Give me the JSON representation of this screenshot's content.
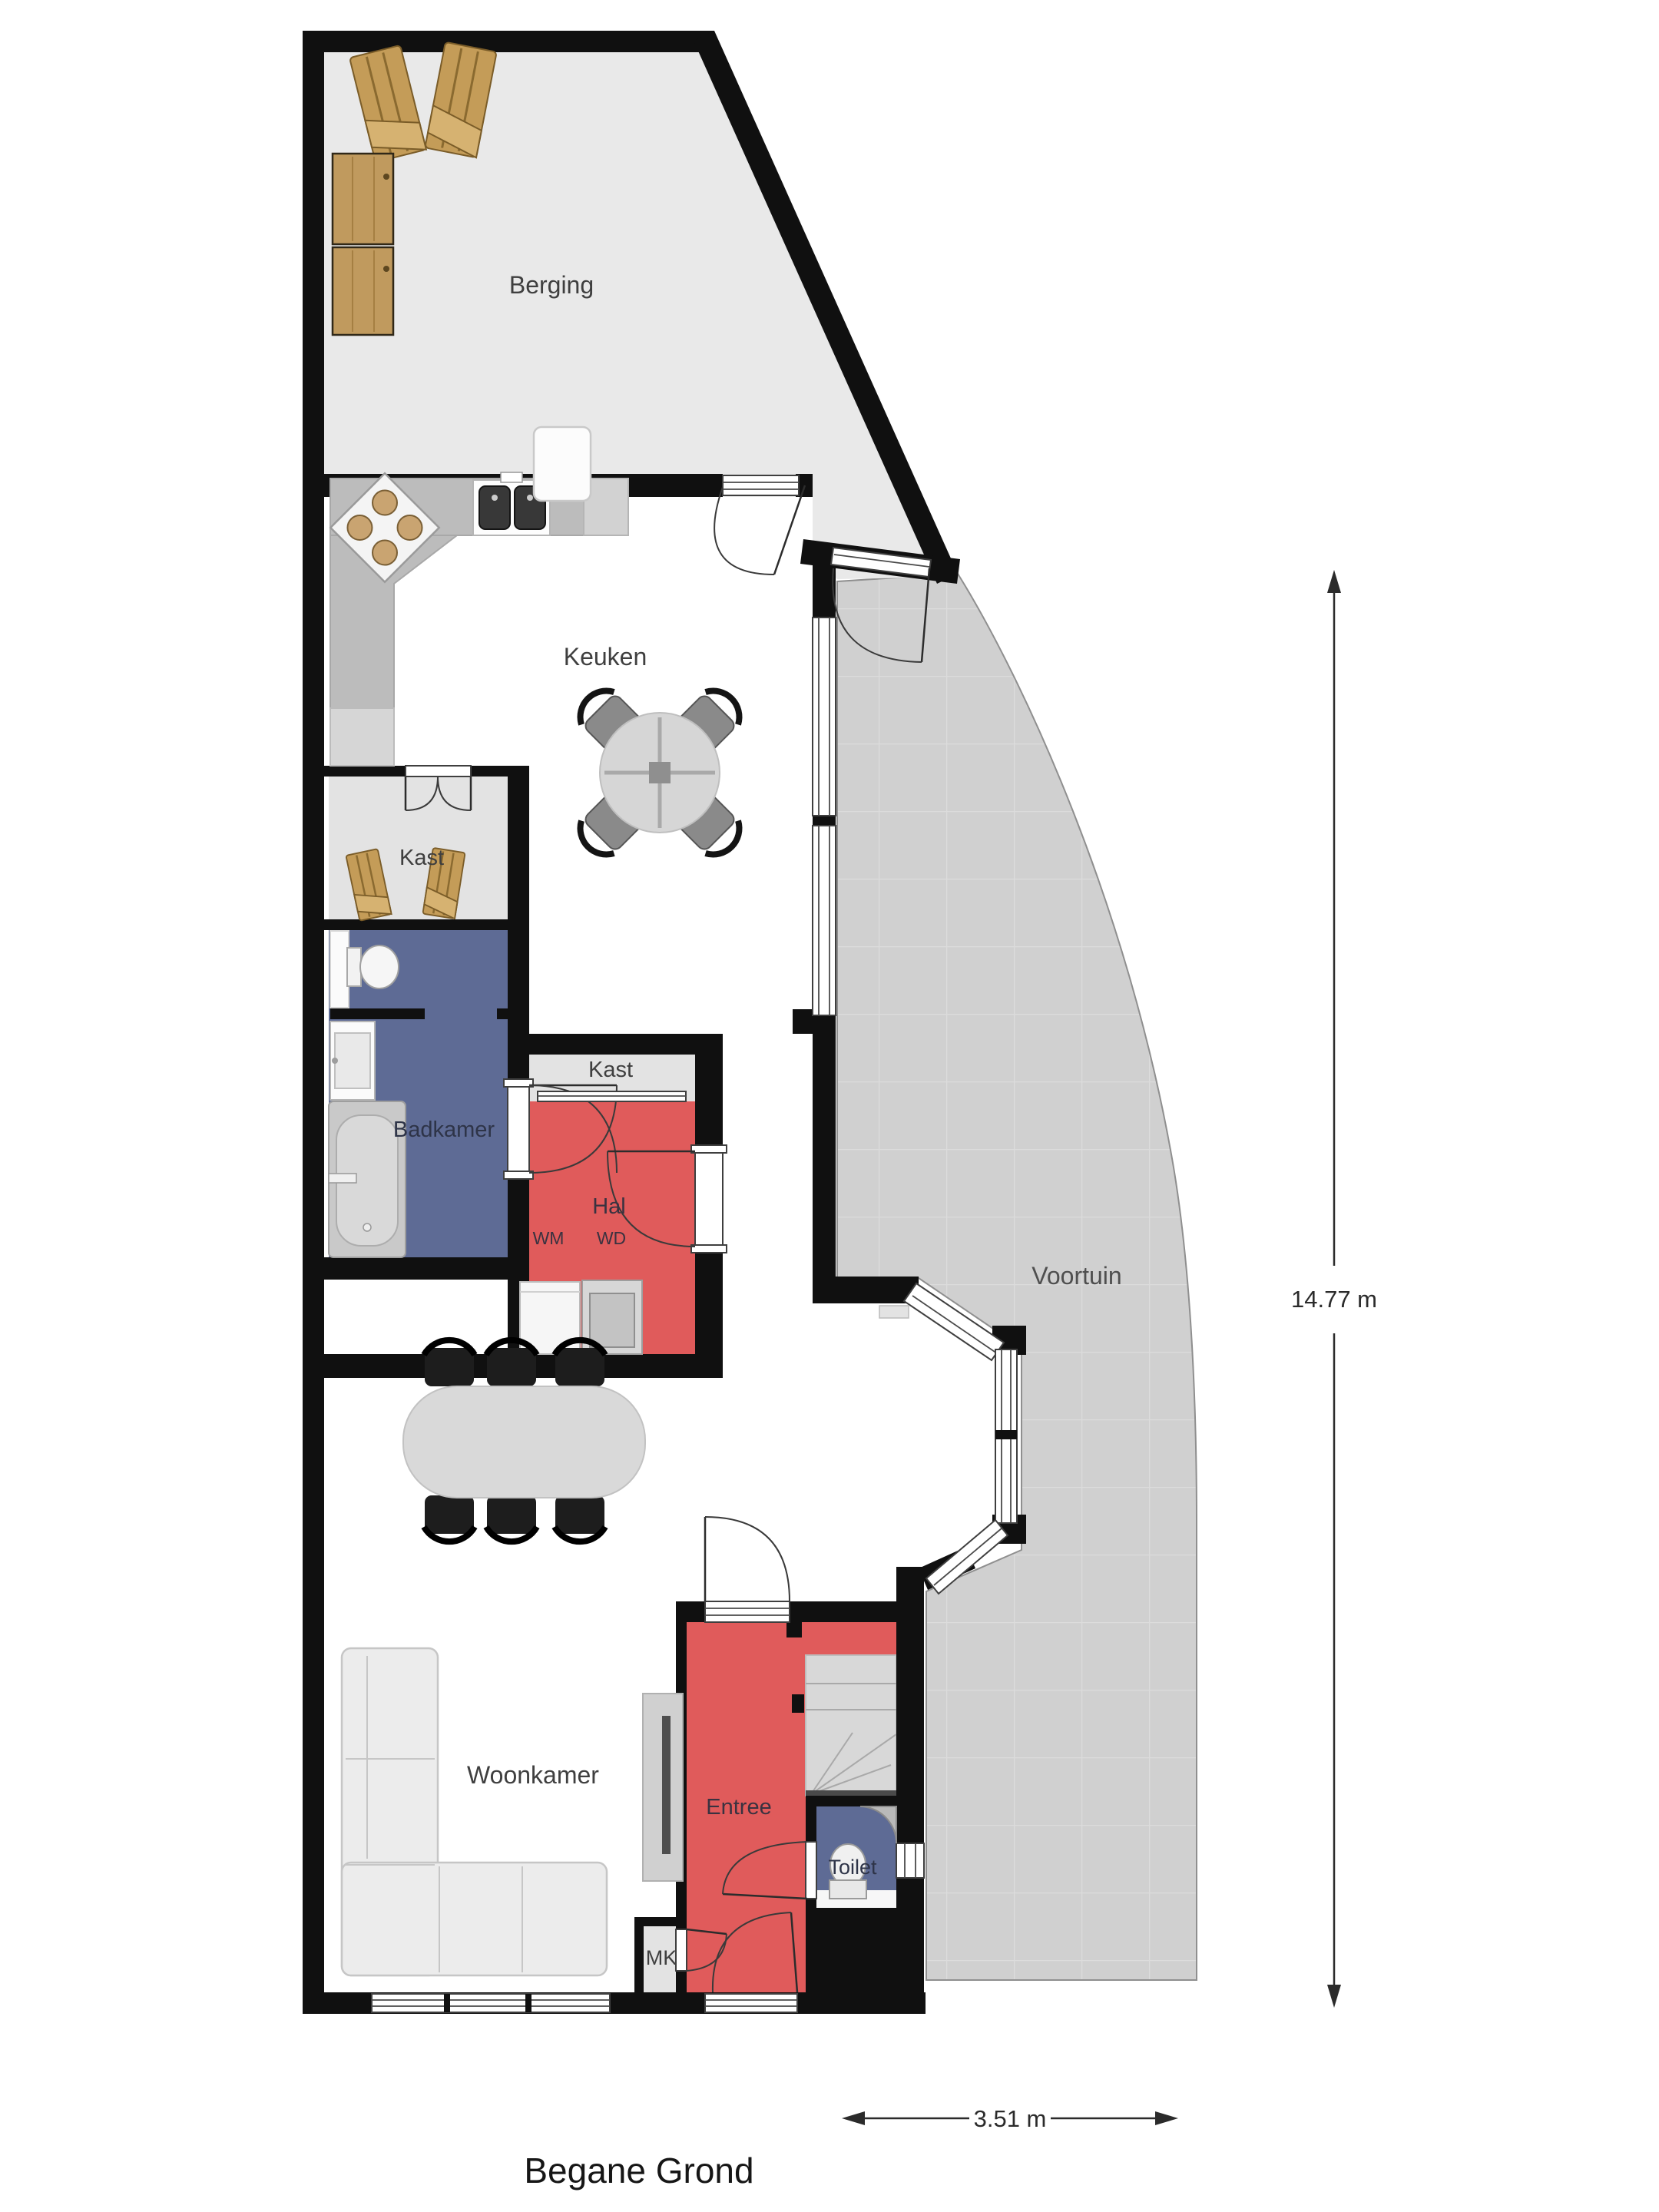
{
  "title": "Begane Grond",
  "rooms": {
    "berging": "Berging",
    "keuken": "Keuken",
    "kast_boven": "Kast",
    "kast_hal": "Kast",
    "badkamer": "Badkamer",
    "hal": "Hal",
    "voortuin": "Voortuin",
    "woonkamer": "Woonkamer",
    "entree": "Entree",
    "toilet": "Toilet"
  },
  "appliances": {
    "wm": "WM",
    "wd": "WD",
    "mk": "MK"
  },
  "dimensions": {
    "vertical": "14.77 m",
    "horizontal": "3.51 m"
  },
  "colors": {
    "wall": "#101010",
    "floor_red": "#e05b5b",
    "floor_blue": "#5e6b95",
    "floor_storage": "#e9e9e9",
    "floor_closet": "#e3e3e3",
    "floor_garden": "#d0d0d0",
    "garden_grid": "#dcdcdc"
  }
}
